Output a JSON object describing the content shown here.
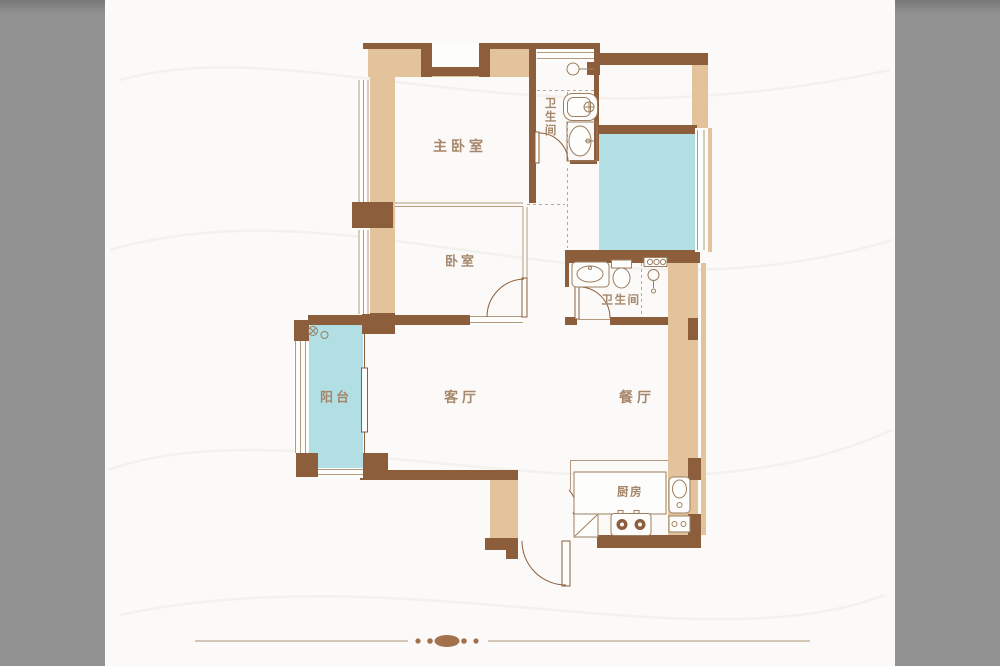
{
  "page": {
    "type": "apartment-floor-plan",
    "colors": {
      "wall": "#8D5E3B",
      "fill": "#E2C39B",
      "glass": "#B2DFE4",
      "label": "#A6876B",
      "line": "#B49A7D",
      "divider": "#A3714B",
      "bg": "#929292",
      "canvas": "#FBFAF8"
    }
  },
  "floor_plan": {
    "rooms": [
      {
        "id": "master-bedroom",
        "label": "主卧室"
      },
      {
        "id": "bathroom-1",
        "label": "卫生间",
        "orientation": "vertical"
      },
      {
        "id": "bedroom",
        "label": "卧室"
      },
      {
        "id": "bathroom-2",
        "label": "卫生间"
      },
      {
        "id": "balcony",
        "label": "阳台"
      },
      {
        "id": "living-room",
        "label": "客厅"
      },
      {
        "id": "dining-room",
        "label": "餐厅"
      },
      {
        "id": "kitchen",
        "label": "厨房"
      }
    ],
    "fixtures": [
      "bathtub",
      "pedestal-sink",
      "washbasin",
      "toilet",
      "shower-head",
      "water-heater",
      "washing-machine-taps",
      "balcony-sliding-door",
      "stove-two-burner",
      "kitchen-sink",
      "fridge",
      "gas-meter",
      "entrance-door",
      "glazed-platform",
      "windows"
    ]
  },
  "footer": {
    "ornament": "divider-line-with-diamond-and-dots"
  }
}
